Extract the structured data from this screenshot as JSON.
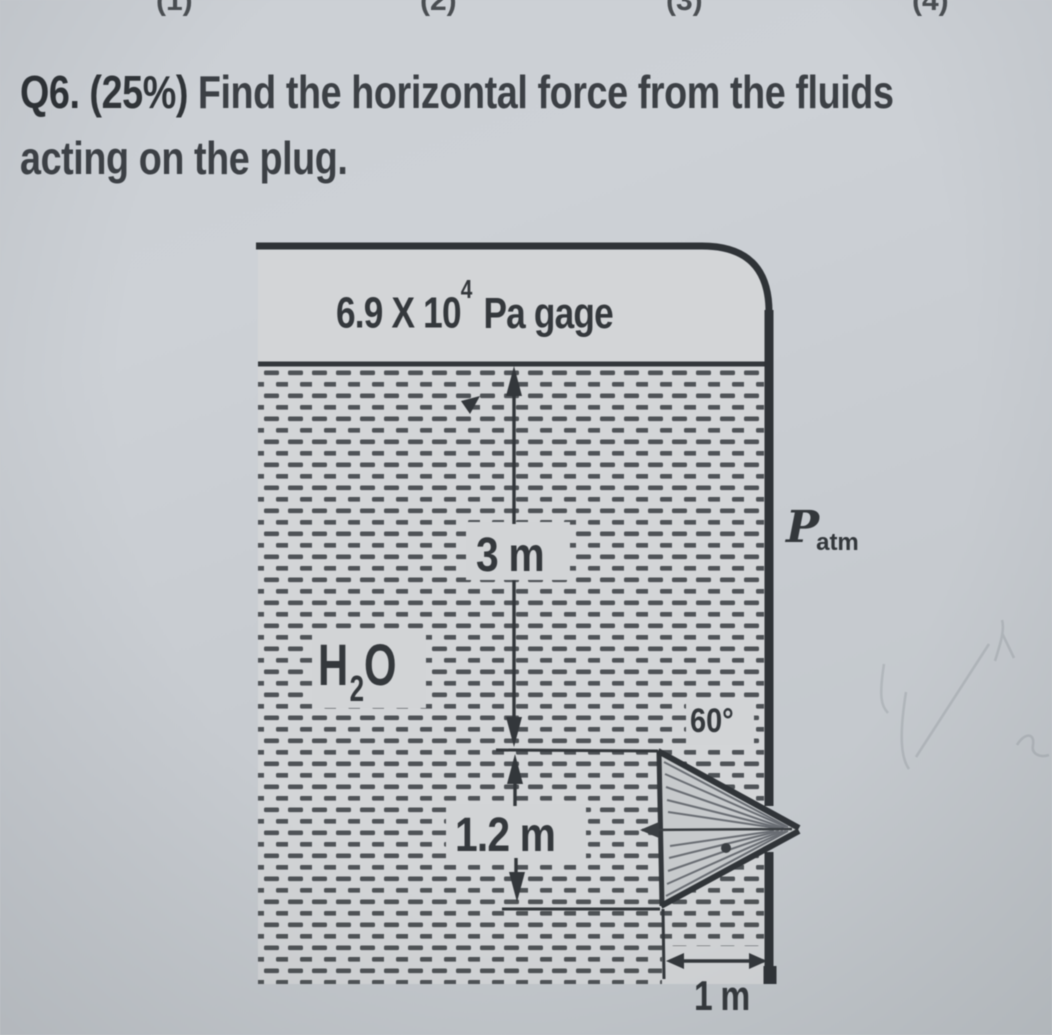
{
  "page": {
    "top_fragments": [
      "(1)",
      "(2)",
      "(3)",
      "(4)"
    ],
    "question": {
      "number": "Q6.",
      "points": "(25%)",
      "line1_rest": "Find the horizontal force from the fluids",
      "line2": "acting on the plug."
    }
  },
  "figure": {
    "pressure_label": {
      "mantissa": "6.9 X 10",
      "exponent": "4",
      "suffix": "Pa gage"
    },
    "water_label": {
      "h": "H",
      "sub": "2",
      "o": "O"
    },
    "atm_label": {
      "symbol": "P",
      "subscript": "atm"
    },
    "dim_depth": "3 m",
    "dim_plug": "1.2 m",
    "dim_offset": "1 m",
    "angle_label": "60°",
    "colors": {
      "ink": "#33373b",
      "paper": "#c9cdd2",
      "tank_interior": "#d3d5d7",
      "hatch": "#44484c"
    }
  }
}
